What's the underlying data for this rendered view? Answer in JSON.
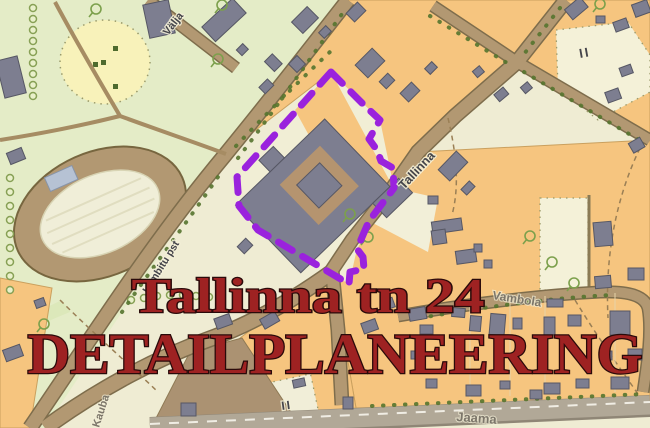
{
  "overlay": {
    "line1": "Tallinna tn 24",
    "line2": "DETAILPLANEERING",
    "color": "#9e2222",
    "outline_color": "#2a0a0a"
  },
  "site": {
    "description": "detail-plan area boundary",
    "boundary_color": "#9a22dd"
  },
  "map": {
    "labels": {
      "valja": "Välja",
      "tallinna": "Tallinna",
      "lembitu": "Lembitu pst",
      "vambola": "Vambola",
      "jaama": "Jaama",
      "kauba": "Kauba",
      "roman_two_a": "II",
      "roman_two_b": "II"
    },
    "colors": {
      "park_green": "#e4ecc7",
      "parcel_cream": "#efecd3",
      "block_orange": "#f6c57f",
      "street_tan": "#b29872",
      "street_casing": "#7e6d4c",
      "building_gray": "#7d7e90",
      "bottom_road_gray": "#b1a897",
      "tree_olive": "#55742f",
      "yellow_patch": "#f8f2ba",
      "courtyard_tan": "#b5946f"
    }
  }
}
